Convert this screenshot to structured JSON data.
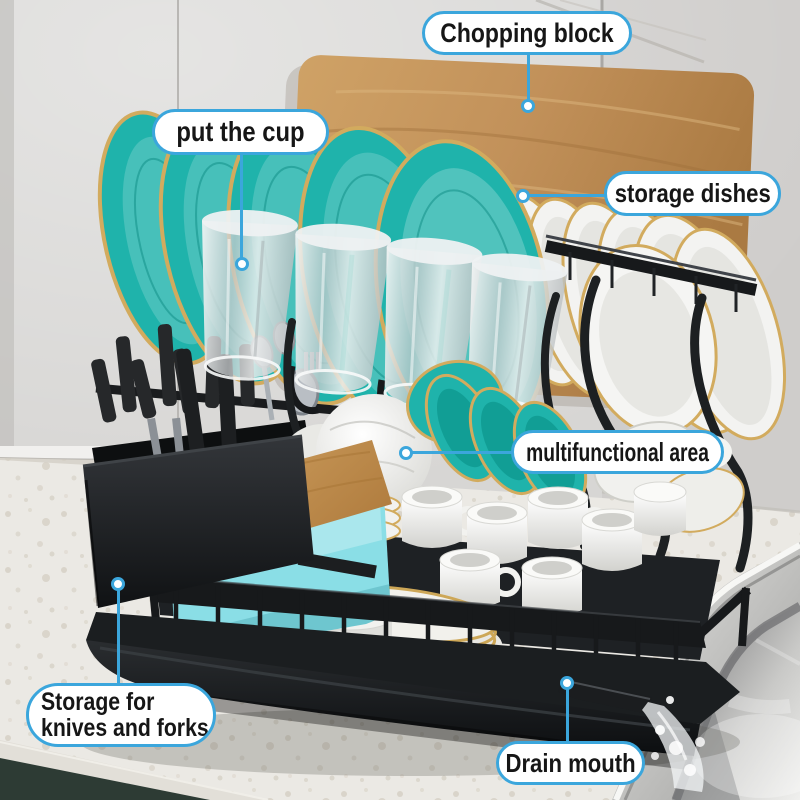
{
  "callouts": {
    "chopping_block": {
      "label": "Chopping block"
    },
    "put_the_cup": {
      "label": "put the cup"
    },
    "storage_dishes": {
      "label": "storage dishes"
    },
    "multifunctional_area": {
      "label": "multifunctional area"
    },
    "storage_knives": {
      "line1": "Storage for",
      "line2": "knives and forks"
    },
    "drain_mouth": {
      "label": "Drain mouth"
    }
  },
  "colors": {
    "callout_accent": "#3BA6DC",
    "teal_dish": "#1FB3AB",
    "gold_rim": "#D2AB5E",
    "wood": "#C2915A",
    "rack_black": "#1B1D1F",
    "cyan_container": "#8ADEE6",
    "counter": "#EBE9E4",
    "cabinet": "#2D3B34",
    "wall": "#D7D6D4"
  }
}
